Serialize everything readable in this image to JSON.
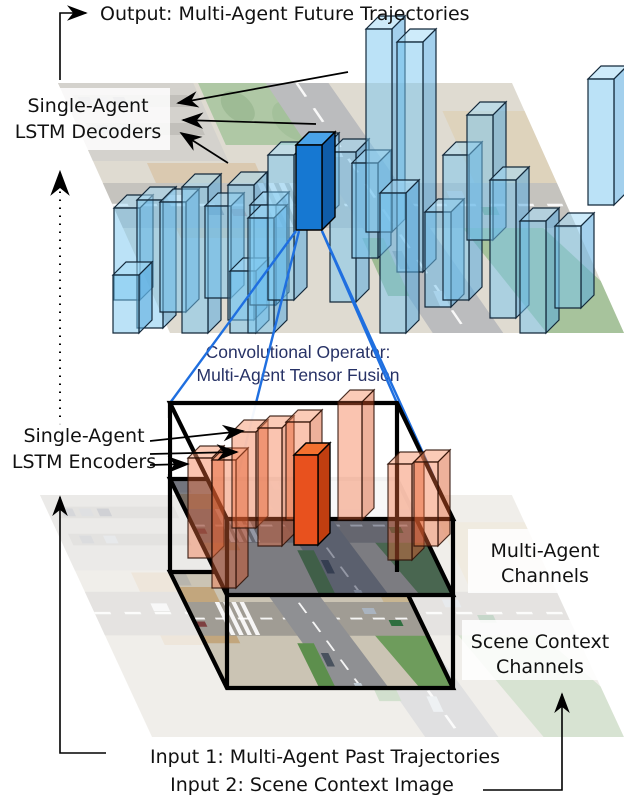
{
  "labels": {
    "output": "Output: Multi-Agent Future Trajectories",
    "decoders_line1": "Single-Agent",
    "decoders_line2": "LSTM Decoders",
    "conv_line1": "Convolutional Operator:",
    "conv_line2": "Multi-Agent Tensor Fusion",
    "encoders_line1": "Single-Agent",
    "encoders_line2": "LSTM Encoders",
    "ma_channels_line1": "Multi-Agent",
    "ma_channels_line2": "Channels",
    "sc_channels_line1": "Scene Context",
    "sc_channels_line2": "Channels",
    "input1": "Input 1: Multi-Agent Past Trajectories",
    "input2": "Input 2: Scene Context Image"
  },
  "colors": {
    "blue_front": "rgba(120,198,240,0.50)",
    "blue_top": "rgba(165,218,246,0.55)",
    "blue_side": "rgba(88,170,222,0.55)",
    "blue_stroke": "#13283a",
    "solid_blue_front": "#1678d2",
    "solid_blue_top": "#4aa3e8",
    "solid_blue_side": "#0f5ca8",
    "orange_front": "rgba(243,108,58,0.40)",
    "orange_top": "rgba(248,152,112,0.50)",
    "orange_side": "rgba(219,84,38,0.46)",
    "orange_stroke": "rgba(45,16,6,0.85)",
    "solid_orange_front": "#e8511e",
    "solid_orange_top": "#f3702f",
    "solid_orange_side": "#c03e10",
    "projection_line": "#1f6fe0",
    "conv_text": "#273266",
    "tensor_edge": "#000000",
    "arrow": "#000000"
  },
  "diagram": {
    "box_w": 26,
    "box_depth": 13,
    "blue_boxes": [
      [
        114,
        300,
        92
      ],
      [
        137,
        328,
        128
      ],
      [
        113,
        333,
        58
      ],
      [
        160,
        312,
        110
      ],
      [
        182,
        333,
        146
      ],
      [
        205,
        298,
        92
      ],
      [
        228,
        320,
        135
      ],
      [
        230,
        333,
        62
      ],
      [
        250,
        305,
        100
      ],
      [
        248,
        333,
        115
      ],
      [
        268,
        300,
        145
      ],
      [
        300,
        218,
        72
      ],
      [
        330,
        302,
        150
      ],
      [
        352,
        258,
        95
      ],
      [
        366,
        232,
        203
      ],
      [
        397,
        272,
        230
      ],
      [
        380,
        333,
        140
      ],
      [
        425,
        307,
        95
      ],
      [
        443,
        300,
        145
      ],
      [
        467,
        240,
        125
      ],
      [
        490,
        318,
        138
      ],
      [
        520,
        333,
        112
      ],
      [
        555,
        308,
        82
      ],
      [
        588,
        205,
        126
      ]
    ],
    "dark_blue_box": [
      296,
      230,
      85
    ],
    "orange_w": 24,
    "orange_depth": 12,
    "orange_boxes": [
      [
        188,
        558,
        100
      ],
      [
        212,
        588,
        128
      ],
      [
        232,
        528,
        96
      ],
      [
        258,
        546,
        118
      ],
      [
        286,
        520,
        98
      ],
      [
        338,
        520,
        118
      ],
      [
        388,
        560,
        96
      ],
      [
        414,
        546,
        84
      ]
    ],
    "solid_orange_box": [
      294,
      545,
      90
    ],
    "projection_lines": [
      [
        296,
        231,
        170,
        403
      ],
      [
        299,
        231,
        227,
        519
      ],
      [
        322,
        231,
        397,
        403
      ],
      [
        322,
        231,
        453,
        519
      ]
    ],
    "decoder_arrows": [
      [
        348,
        72,
        178,
        103
      ],
      [
        316,
        124,
        183,
        120
      ],
      [
        228,
        163,
        181,
        133
      ]
    ],
    "encoder_arrows": [
      [
        150,
        441,
        243,
        431
      ],
      [
        150,
        454,
        237,
        452
      ],
      [
        150,
        465,
        188,
        464
      ]
    ]
  }
}
